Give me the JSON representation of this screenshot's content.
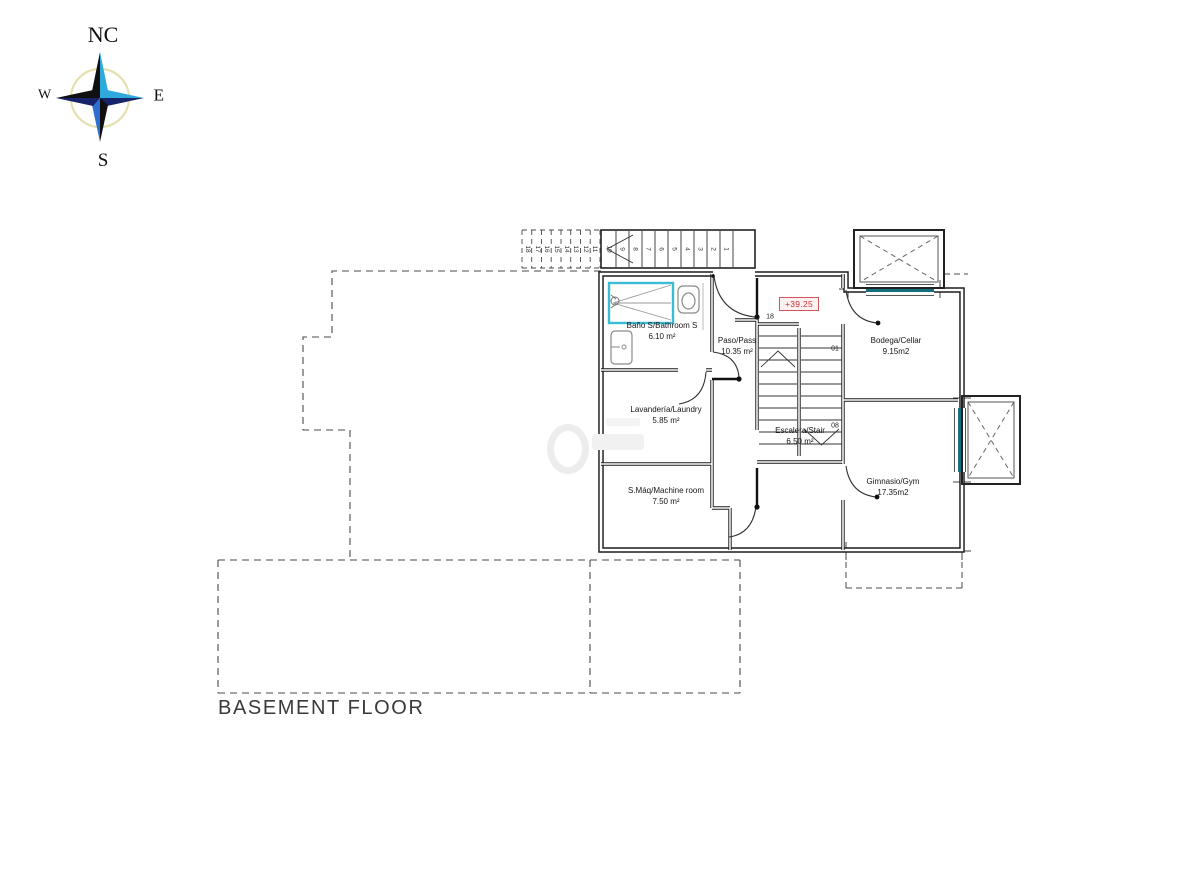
{
  "title": "BASEMENT FLOOR",
  "compass": {
    "north": "NC",
    "east": "E",
    "south": "S",
    "west": "W"
  },
  "elevation_label": "+39.25",
  "rooms": {
    "bathroom": {
      "name": "Baño S/Bathroom S",
      "area": "6.10 m²"
    },
    "pass": {
      "name": "Paso/Pass",
      "area": "10.35 m²"
    },
    "laundry": {
      "name": "Lavandería/Laundry",
      "area": "5.85 m²"
    },
    "machine": {
      "name": "S.Máq/Machine room",
      "area": "7.50 m²"
    },
    "stair": {
      "name": "Escalera/Stair",
      "area": "6.50 m²"
    },
    "cellar": {
      "name": "Bodega/Cellar",
      "area": "9.15m2"
    },
    "gym": {
      "name": "Gimnasio/Gym",
      "area": "17.35m2"
    }
  },
  "stair_marks": {
    "interior_top": "01",
    "interior_bottom": "08",
    "upper_step": "18"
  },
  "exterior_stair": {
    "solid_numbers": [
      "10",
      "9",
      "8",
      "7",
      "6",
      "5",
      "4",
      "3",
      "2",
      "1"
    ],
    "dashed_numbers": [
      "18",
      "17",
      "16",
      "15",
      "14",
      "13",
      "12",
      "11"
    ]
  },
  "colors": {
    "wall": "#1c1c1c",
    "shower_cyan": "#3bbcd4",
    "window_teal": "#14707e",
    "elevation_red": "#c8323c"
  }
}
